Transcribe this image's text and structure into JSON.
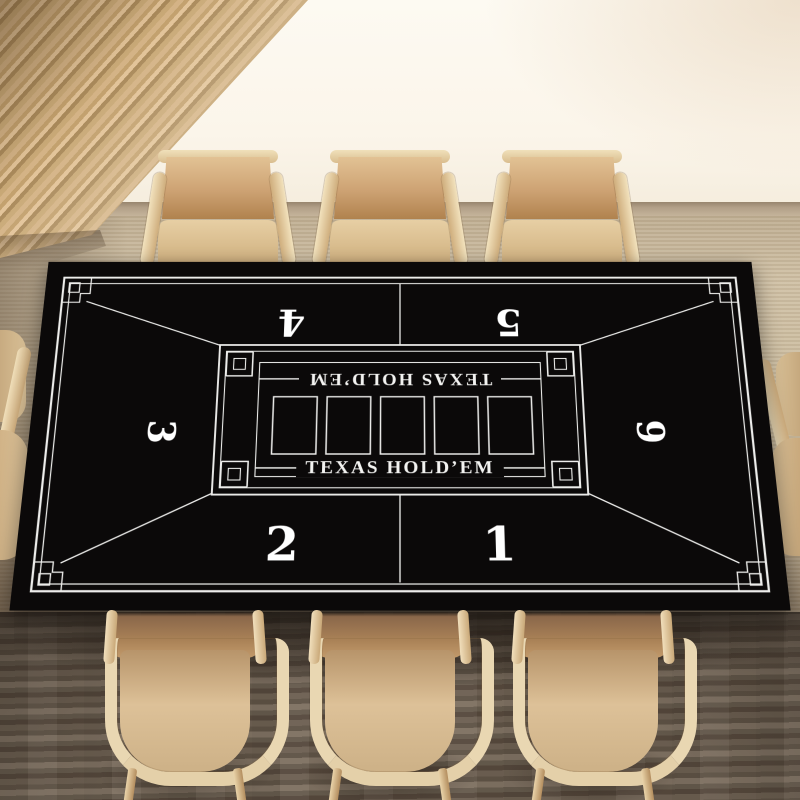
{
  "poker_mat": {
    "title_top": "TEXAS HOLD’EM",
    "title_bottom": "TEXAS HOLD’EM",
    "seat_numbers": [
      "1",
      "2",
      "3",
      "4",
      "5",
      "6"
    ],
    "card_slot_count": 5,
    "colors": {
      "background": "#0b0909",
      "line": "#ededeb",
      "number": "#ffffff"
    }
  },
  "room": {
    "colors": {
      "window_light": "#fbf6ec",
      "wood_slat_wall": "#c8a679",
      "chair_wood_frame": "#e9d7b2",
      "chair_upholstery": "#c79e6d",
      "carpet_far": "#ccbda2",
      "carpet_near": "#675c50"
    }
  }
}
